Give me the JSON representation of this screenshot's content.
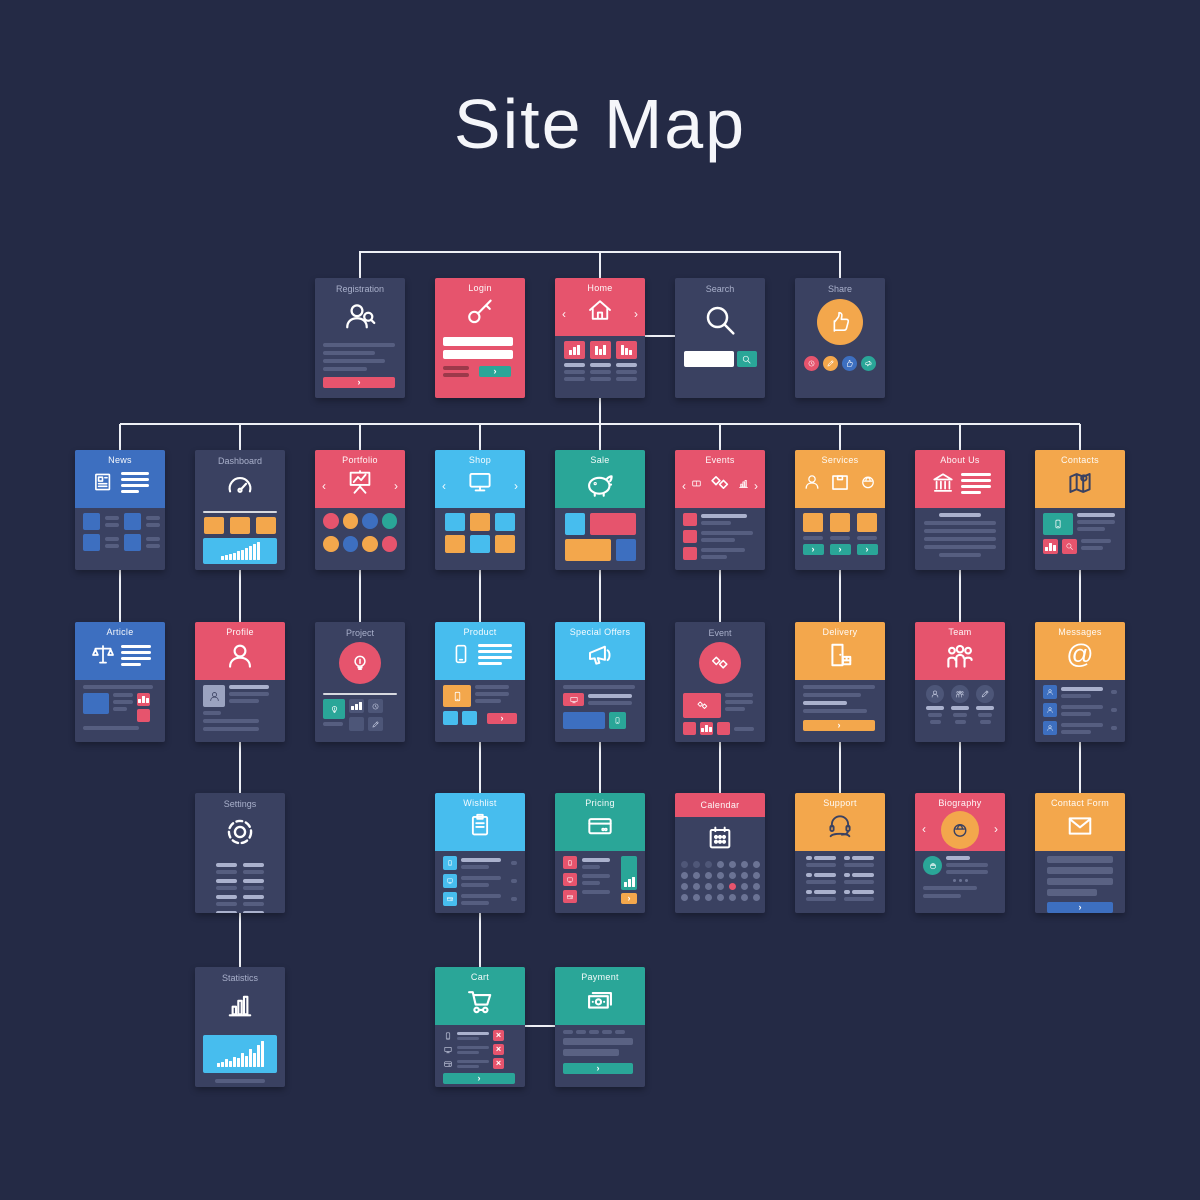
{
  "title": "Site Map",
  "palette": {
    "background": "#242a45",
    "card": "#3a4161",
    "red": "#e6546d",
    "orange": "#f3a74c",
    "teal": "#2aa698",
    "blue": "#3d6fc0",
    "light_blue": "#47bdee",
    "line_gray": "#767fa3",
    "connector": "#eef0f6",
    "white": "#ffffff"
  },
  "nodes": [
    {
      "id": "registration",
      "label": "Registration",
      "row": 1,
      "col": 3,
      "style": "dark",
      "icon": "person-search-icon"
    },
    {
      "id": "login",
      "label": "Login",
      "row": 1,
      "col": 4,
      "style": "red-full",
      "icon": "key-icon"
    },
    {
      "id": "home",
      "label": "Home",
      "row": 1,
      "col": 5,
      "style": "red",
      "icon": "house-icon"
    },
    {
      "id": "search",
      "label": "Search",
      "row": 1,
      "col": 6,
      "style": "dark",
      "icon": "magnifier-icon"
    },
    {
      "id": "share",
      "label": "Share",
      "row": 1,
      "col": 7,
      "style": "dark",
      "icon": "thumb-up-icon"
    },
    {
      "id": "news",
      "label": "News",
      "row": 2,
      "col": 1,
      "style": "blue",
      "icon": "newspaper-icon"
    },
    {
      "id": "dashboard",
      "label": "Dashboard",
      "row": 2,
      "col": 2,
      "style": "dark",
      "icon": "gauge-icon"
    },
    {
      "id": "portfolio",
      "label": "Portfolio",
      "row": 2,
      "col": 3,
      "style": "red",
      "icon": "easel-chart-icon"
    },
    {
      "id": "shop",
      "label": "Shop",
      "row": 2,
      "col": 4,
      "style": "light-blue",
      "icon": "monitor-icon"
    },
    {
      "id": "sale",
      "label": "Sale",
      "row": 2,
      "col": 5,
      "style": "teal",
      "icon": "piggy-bank-icon"
    },
    {
      "id": "events",
      "label": "Events",
      "row": 2,
      "col": 6,
      "style": "red",
      "icon": "handshake-icon"
    },
    {
      "id": "services",
      "label": "Services",
      "row": 2,
      "col": 7,
      "style": "orange",
      "icon": "box-icon"
    },
    {
      "id": "about-us",
      "label": "About Us",
      "row": 2,
      "col": 8,
      "style": "red",
      "icon": "bank-icon"
    },
    {
      "id": "contacts",
      "label": "Contacts",
      "row": 2,
      "col": 9,
      "style": "orange",
      "icon": "map-icon"
    },
    {
      "id": "article",
      "label": "Article",
      "row": 3,
      "col": 1,
      "style": "blue",
      "icon": "scales-icon"
    },
    {
      "id": "profile",
      "label": "Profile",
      "row": 3,
      "col": 2,
      "style": "red",
      "icon": "person-icon"
    },
    {
      "id": "project",
      "label": "Project",
      "row": 3,
      "col": 3,
      "style": "dark",
      "icon": "bulb-icon"
    },
    {
      "id": "product",
      "label": "Product",
      "row": 3,
      "col": 4,
      "style": "light-blue",
      "icon": "phone-icon"
    },
    {
      "id": "special-offers",
      "label": "Special Offers",
      "row": 3,
      "col": 5,
      "style": "light-blue",
      "icon": "megaphone-icon"
    },
    {
      "id": "event",
      "label": "Event",
      "row": 3,
      "col": 6,
      "style": "dark",
      "icon": "handshake-icon"
    },
    {
      "id": "delivery",
      "label": "Delivery",
      "row": 3,
      "col": 7,
      "style": "orange",
      "icon": "door-box-icon"
    },
    {
      "id": "team",
      "label": "Team",
      "row": 3,
      "col": 8,
      "style": "red",
      "icon": "team-icon"
    },
    {
      "id": "messages",
      "label": "Messages",
      "row": 3,
      "col": 9,
      "style": "orange",
      "icon": "at-sign-icon"
    },
    {
      "id": "settings",
      "label": "Settings",
      "row": 4,
      "col": 2,
      "style": "dark",
      "icon": "gear-icon"
    },
    {
      "id": "wishlist",
      "label": "Wishlist",
      "row": 4,
      "col": 4,
      "style": "light-blue",
      "icon": "clipboard-icon"
    },
    {
      "id": "pricing",
      "label": "Pricing",
      "row": 4,
      "col": 5,
      "style": "teal",
      "icon": "credit-card-icon"
    },
    {
      "id": "calendar",
      "label": "Calendar",
      "row": 4,
      "col": 6,
      "style": "red-strip",
      "icon": "calendar-icon"
    },
    {
      "id": "support",
      "label": "Support",
      "row": 4,
      "col": 7,
      "style": "orange",
      "icon": "headset-icon"
    },
    {
      "id": "biography",
      "label": "Biography",
      "row": 4,
      "col": 8,
      "style": "red",
      "icon": "worker-icon"
    },
    {
      "id": "contact-form",
      "label": "Contact Form",
      "row": 4,
      "col": 9,
      "style": "orange",
      "icon": "envelope-icon"
    },
    {
      "id": "statistics",
      "label": "Statistics",
      "row": 5,
      "col": 2,
      "style": "dark",
      "icon": "bar-chart-icon"
    },
    {
      "id": "cart",
      "label": "Cart",
      "row": 5,
      "col": 4,
      "style": "teal",
      "icon": "cart-icon"
    },
    {
      "id": "payment",
      "label": "Payment",
      "row": 5,
      "col": 5,
      "style": "teal",
      "icon": "banknote-icon"
    }
  ],
  "edges": [
    [
      "home",
      "registration"
    ],
    [
      "home",
      "share"
    ],
    [
      "home",
      "search"
    ],
    [
      "home",
      "news"
    ],
    [
      "home",
      "dashboard"
    ],
    [
      "home",
      "portfolio"
    ],
    [
      "home",
      "shop"
    ],
    [
      "home",
      "sale"
    ],
    [
      "home",
      "events"
    ],
    [
      "home",
      "services"
    ],
    [
      "home",
      "about-us"
    ],
    [
      "home",
      "contacts"
    ],
    [
      "news",
      "article"
    ],
    [
      "dashboard",
      "profile"
    ],
    [
      "portfolio",
      "project"
    ],
    [
      "shop",
      "product"
    ],
    [
      "sale",
      "special-offers"
    ],
    [
      "events",
      "event"
    ],
    [
      "services",
      "delivery"
    ],
    [
      "about-us",
      "team"
    ],
    [
      "contacts",
      "messages"
    ],
    [
      "profile",
      "settings"
    ],
    [
      "product",
      "wishlist"
    ],
    [
      "special-offers",
      "pricing"
    ],
    [
      "event",
      "calendar"
    ],
    [
      "delivery",
      "support"
    ],
    [
      "team",
      "biography"
    ],
    [
      "messages",
      "contact-form"
    ],
    [
      "settings",
      "statistics"
    ],
    [
      "wishlist",
      "cart"
    ],
    [
      "cart",
      "payment"
    ]
  ]
}
